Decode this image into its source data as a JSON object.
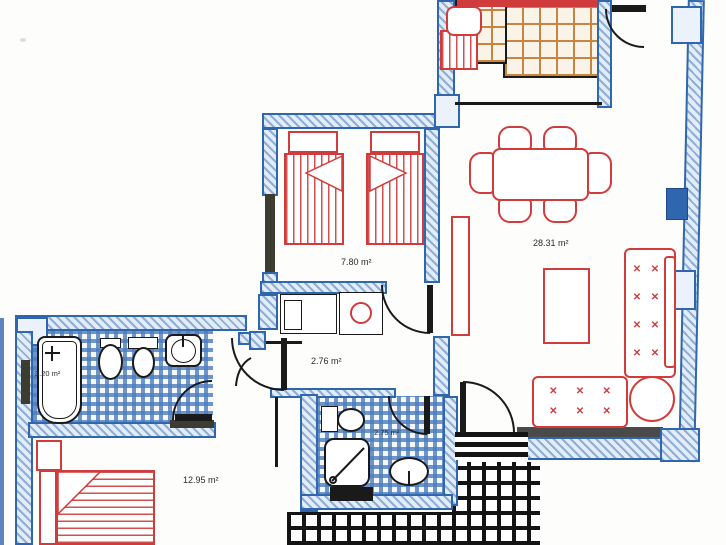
{
  "document": {
    "type": "apartment floor plan",
    "style": "scanned architectural drawing, blue walls, red furniture"
  },
  "colors": {
    "wall_blue": "#2f66ad",
    "wall_fill": "#dcebf8",
    "furniture_red": "#d03c3c",
    "fixture_black": "#1a1a1a",
    "kitchen_tile_orange": "#c8853f",
    "terrace_grid_black": "#141414"
  },
  "rooms": [
    {
      "name": "bedroom-twin",
      "area_label": "7.80 m²"
    },
    {
      "name": "living-dining-room",
      "area_label": "28.31 m²"
    },
    {
      "name": "corridor",
      "area_label": "2.76 m²"
    },
    {
      "name": "bathroom-main",
      "area_label": "3.20 m²"
    },
    {
      "name": "shower-room",
      "area_label": "2.75 m²"
    },
    {
      "name": "bedroom-double",
      "area_label": "12.95 m²"
    }
  ],
  "marks": {
    "x": "✕"
  },
  "furniture": [
    "twin-bed",
    "twin-bed",
    "dining-table-six-chairs",
    "sofa-large",
    "sofa-small",
    "round-side-table",
    "coffee-table",
    "sideboard",
    "double-bed",
    "nightstand",
    "washing-machine",
    "kitchen-sink-unit"
  ],
  "fixtures": [
    "bathtub",
    "bidet",
    "toilet",
    "washbasin",
    "toilet-2",
    "shower",
    "washbasin-2",
    "entry-door",
    "interior-doors",
    "windows",
    "terrace-steps"
  ]
}
